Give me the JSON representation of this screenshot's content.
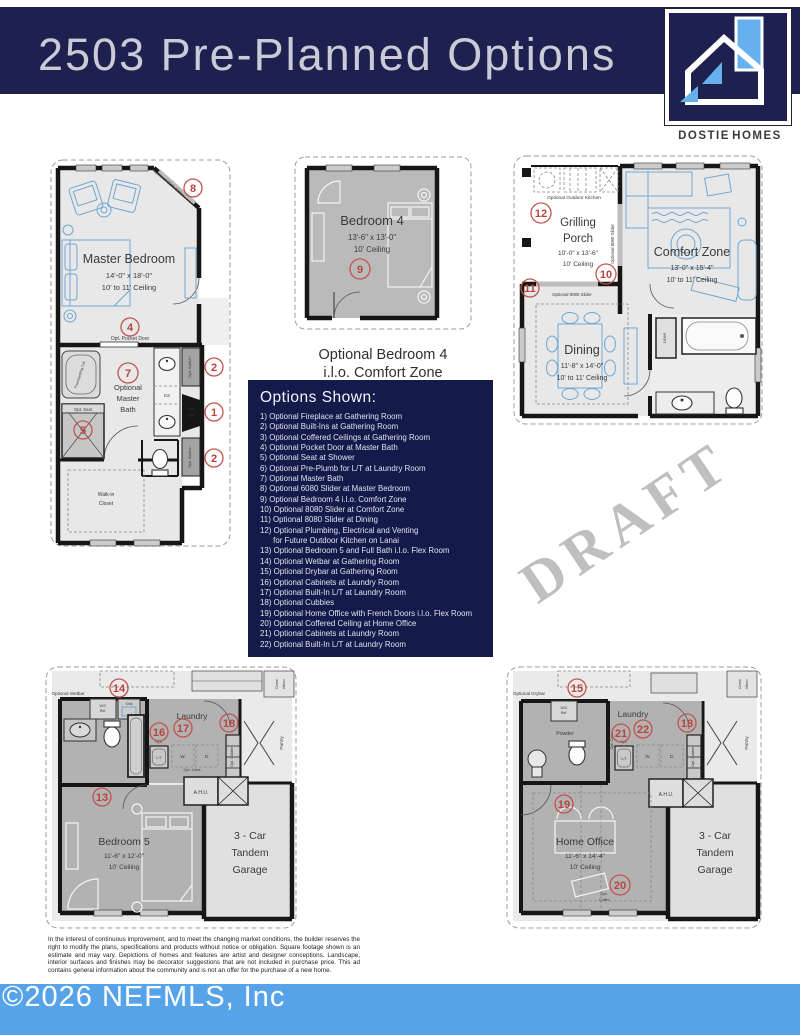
{
  "header": {
    "title": "2503 Pre-Planned Options"
  },
  "logo": {
    "brand_primary": "DOSTIE",
    "brand_secondary": "HOMES"
  },
  "watermark": "DRAFT",
  "options_panel": {
    "title": "Options Shown:",
    "items": [
      "1) Optional Fireplace at Gathering Room",
      "2) Optional Built-Ins at Gathering Room",
      "3) Optional Coffered Ceilings at Gathering Room",
      "4) Optional Pocket Door at Master Bath",
      "5) Optional Seat at Shower",
      "6) Optional Pre-Plumb for L/T at Laundry Room",
      "7) Optional Master Bath",
      "8) Optional 6080 Slider at Master Bedroom",
      "9) Optional Bedroom 4 i.l.o. Comfort Zone",
      "10) Optional 8080 Slider at Comfort Zone",
      "11) Optional 8080 Slider at Dining",
      "12) Optional Plumbing, Electrical and Venting",
      "      for Future Outdoor Kitchen on Lanai",
      "13) Optional Bedroom 5 and Full Bath i.l.o. Flex Room",
      "14) Optional Wetbar at Gathering Room",
      "15) Optional Drybar at Gathering Room",
      "16) Optional Cabinets at Laundry Room",
      "17) Optional Built-In L/T at Laundry Room",
      "18) Optional Cubbies",
      "19) Optional Home Office with French Doors i.l.o. Flex Room",
      "20) Optional Coffered Ceiling at Home Office",
      "21) Optional Cabinets at Laundry Room",
      "22) Optional Built-In L/T at Laundry Room"
    ]
  },
  "plans": {
    "master": {
      "room": "Master Bedroom",
      "dims": "14'-0\" x 18'-0\"",
      "ceiling": "10' to 11' Ceiling",
      "slider_label": "Optional 6080 Slider",
      "pocket_door": "Opt. Pocket Door",
      "bath1": "Optional",
      "bath2": "Master",
      "bath3": "Bath",
      "tub": "Freestanding Tub",
      "seat": "Opt. Seat",
      "built_in_a": "Opt. Built-In",
      "built_in_b": "Opt. Built-In",
      "fp1": "Opt.",
      "fp2": "F/P",
      "ks": "KS",
      "closet1": "Walk-in",
      "closet2": "Closet",
      "m8": "8",
      "m4": "4",
      "m7": "7",
      "m5": "5",
      "m2a": "2",
      "m1": "1",
      "m2b": "2"
    },
    "bedroom4": {
      "room": "Bedroom 4",
      "dims": "13'-6\" x 13'-0\"",
      "ceiling": "10' Ceiling",
      "m9": "9",
      "caption1": "Optional Bedroom 4",
      "caption2": "i.l.o. Comfort Zone"
    },
    "comfort": {
      "porch1": "Grilling",
      "porch2": "Porch",
      "porch_dims": "10'-0\" x 13'-6\"",
      "porch_ceiling": "10' Ceiling",
      "outdoor_kitchen": "Optional Outdoor Kitchen",
      "slider_v": "Optional 8080 Slider",
      "slider_h": "Optional 8080 Slider",
      "zone": "Comfort Zone",
      "zone_dims": "13'-0\" x 15'-4\"",
      "zone_ceiling": "10' to 11' Ceiling",
      "dining": "Dining",
      "dining_dims": "11'-8\" x 14'-0\"",
      "dining_ceiling": "10' to 11' Ceiling",
      "linen": "Linen",
      "m12": "12",
      "m10": "10",
      "m11": "11"
    },
    "flex_left": {
      "wetbar": "Optional Wetbar",
      "wc1": "W/C",
      "wc2": "Ref.",
      "sink": "Sink",
      "laundry": "Laundry",
      "opt": "Opt.",
      "lt": "L/T",
      "w": "W.",
      "d": "D.",
      "cabs": "Opt. Cabs",
      "cubbie": "Opt. Cubbie",
      "pantry": "Pantry",
      "oven1": "Oven/",
      "oven2": "Micro",
      "ahu": "A.H.U.",
      "room": "Bedroom 5",
      "dims": "11'-6\" x 12'-0\"",
      "ceiling": "10' Ceiling",
      "g1": "3 - Car",
      "g2": "Tandem",
      "g3": "Garage",
      "m14": "14",
      "m16": "16",
      "m17": "17",
      "m18": "18",
      "m13": "13"
    },
    "flex_right": {
      "drybar": "Optional Drybar",
      "wc1": "W/C",
      "wc2": "Ref.",
      "powder": "Powder",
      "laundry": "Laundry",
      "opt": "Opt.",
      "lt": "L/T",
      "w": "W.",
      "d": "D.",
      "cabs": "Opt. Cabs",
      "cubbie": "Opt. Cubbie",
      "pantry": "Pantry",
      "oven1": "Oven/",
      "oven2": "Micro",
      "ahu": "A.H.U.",
      "coffer1": "Opt.",
      "coffer2": "Coffer",
      "room": "Home Office",
      "dims": "11'-6\" x 14'-4\"",
      "ceiling": "10' Ceiling",
      "g1": "3 - Car",
      "g2": "Tandem",
      "g3": "Garage",
      "m15": "15",
      "m21": "21",
      "m22": "22",
      "m18": "18",
      "m19": "19",
      "m20": "20"
    }
  },
  "disclaimer": "In the interest of continuous improvement, and to meet the changing market conditions, the builder reserves the right to modify the plans, specifications and products without notice or obligation. Square footage shown is an estimate and may vary. Depictions of homes and features are artist and designer conceptions. Landscape, interior surfaces and finishes may be decorator suggestions that are not included in purchase price. This ad contains general information about the community and is not an offer for the purchase of a new home.",
  "footer": {
    "copyright": "©2026 NEFMLS, Inc"
  }
}
